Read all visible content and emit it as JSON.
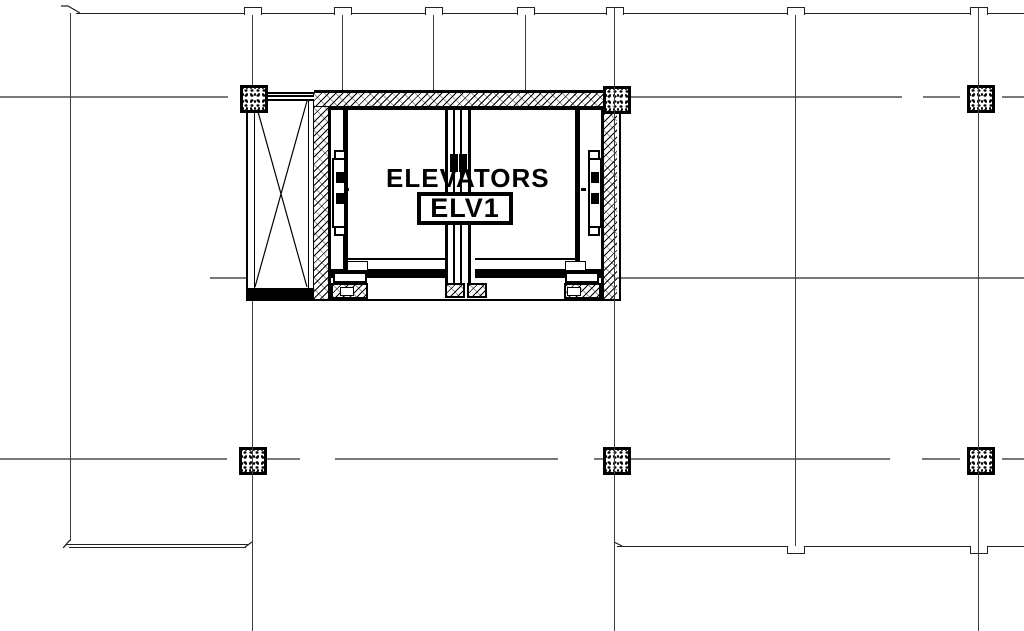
{
  "labels": {
    "room": "ELEVATORS",
    "tag": "ELV1"
  },
  "colors": {
    "background": "#ffffff",
    "drawing_line": "#000000",
    "grid_line": "#7a7a7a"
  }
}
